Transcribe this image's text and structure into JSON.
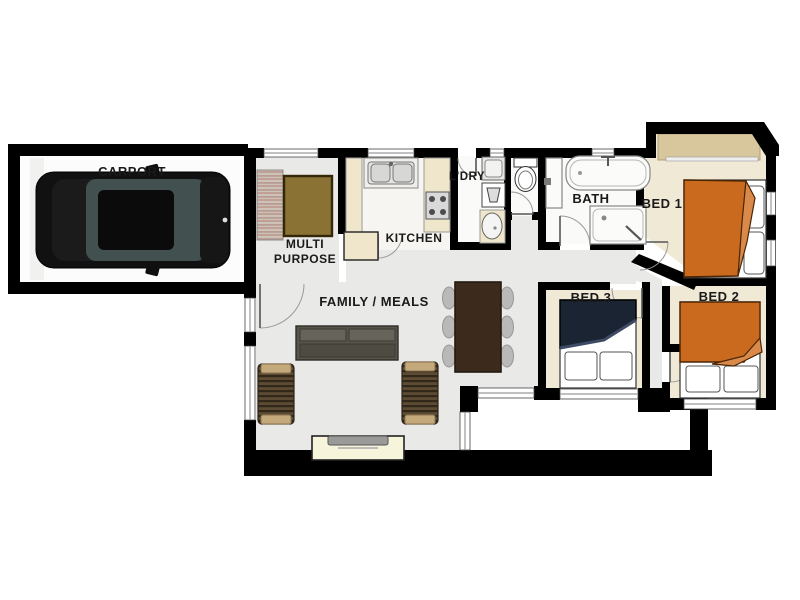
{
  "plan": {
    "labels": {
      "carport": "CARPORT",
      "multi_line1": "MULTI",
      "multi_line2": "PURPOSE",
      "kitchen": "KITCHEN",
      "laundry": "L'DRY",
      "bath": "BATH",
      "bed1": "BED 1",
      "bed2": "BED 2",
      "bed3": "BED 3",
      "family_meals": "FAMILY / MEALS"
    },
    "colors": {
      "wall": "#000000",
      "floor_living": "#e9e9e7",
      "floor_bedroom": "#f0e9d6",
      "floor_wet": "#fafaf8",
      "floor_carport": "#fcfcfc",
      "bed_orange": "#c96a1e",
      "bed_orange_fold": "#d98a4a",
      "bed_navy": "#1b2433",
      "rug_brown": "#8a7134",
      "armchair_tan": "#c4a97b",
      "wardrobe_tan": "#d8c69c",
      "table_timber": "#3c2b1c",
      "sofa_olive": "#57544a",
      "tv_unit_cream": "#f7f4dc",
      "kitchen_bench_cream": "#efe6cb",
      "car_black": "#111111"
    }
  }
}
